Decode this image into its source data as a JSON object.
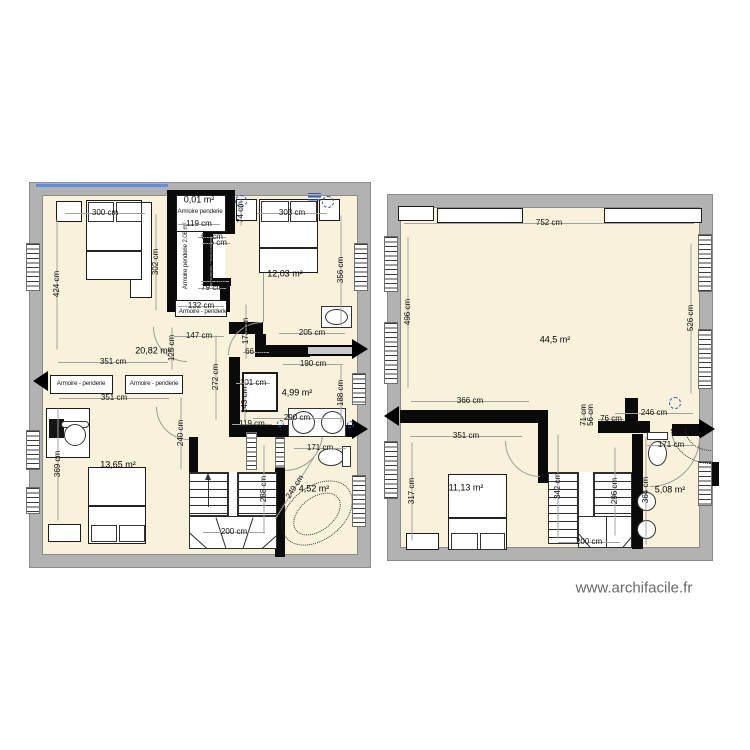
{
  "watermark": "www.archifacile.fr",
  "colors": {
    "floor": "#f8f2da",
    "outer_wall": "#b2b2b2",
    "inner_wall": "#0a0a0a",
    "dimension_line": "#a3a3a3",
    "accent_blue": "#2e58c8",
    "top_wall_highlight": "#5b8def",
    "watermark_text": "#686868"
  },
  "plans": [
    {
      "id": "left",
      "labels": [
        {
          "t": "0,01 m²",
          "x": 199,
          "y": 200,
          "k": "area"
        },
        {
          "t": "12,03 m²",
          "x": 285,
          "y": 274,
          "k": "area"
        },
        {
          "t": "20,82 m²",
          "x": 153,
          "y": 351,
          "k": "area"
        },
        {
          "t": "4,99 m²",
          "x": 297,
          "y": 393,
          "k": "area"
        },
        {
          "t": "13,65 m²",
          "x": 118,
          "y": 465,
          "k": "area"
        },
        {
          "t": "4,52 m²",
          "x": 314,
          "y": 489,
          "k": "area"
        },
        {
          "t": "Armoire penderie",
          "x": 200,
          "y": 212,
          "k": "furn"
        },
        {
          "t": "Armoire penderie 2,08 m²",
          "x": 186,
          "y": 256,
          "k": "furn",
          "rot": -90
        },
        {
          "t": "Armoire - penderie",
          "x": 203,
          "y": 312,
          "k": "furn"
        },
        {
          "t": "Armoire - penderie",
          "x": 81,
          "y": 384,
          "k": "furn"
        },
        {
          "t": "Armoire - penderie",
          "x": 154,
          "y": 384,
          "k": "furn"
        },
        {
          "t": "300 cm",
          "x": 105,
          "y": 213,
          "len": 80
        },
        {
          "t": "303 cm",
          "x": 292,
          "y": 213,
          "len": 70
        },
        {
          "t": "119 cm",
          "x": 199,
          "y": 224,
          "len": 42
        },
        {
          "t": "74 cm",
          "x": 241,
          "y": 212,
          "len": 26,
          "rot": -90
        },
        {
          "t": "66 cm",
          "x": 212,
          "y": 237,
          "len": 28
        },
        {
          "t": "66 cm",
          "x": 216,
          "y": 243,
          "len": 28
        },
        {
          "t": "154 cm",
          "x": 211,
          "y": 261,
          "len": 50,
          "rot": -90
        },
        {
          "t": "302 cm",
          "x": 156,
          "y": 262,
          "len": 96,
          "rot": -90
        },
        {
          "t": "356 cm",
          "x": 341,
          "y": 270,
          "len": 110,
          "rot": -90
        },
        {
          "t": "424 cm",
          "x": 57,
          "y": 284,
          "len": 130,
          "rot": -90
        },
        {
          "t": "79 cm",
          "x": 215,
          "y": 281,
          "len": 28
        },
        {
          "t": "79 cm",
          "x": 212,
          "y": 288,
          "len": 28
        },
        {
          "t": "132 cm",
          "x": 201,
          "y": 306,
          "len": 46
        },
        {
          "t": "147 cm",
          "x": 199,
          "y": 336,
          "len": 50
        },
        {
          "t": "173 cm",
          "x": 246,
          "y": 331,
          "len": 54,
          "rot": -90
        },
        {
          "t": "125 cm",
          "x": 172,
          "y": 348,
          "len": 42,
          "rot": -90
        },
        {
          "t": "205 cm",
          "x": 312,
          "y": 333,
          "len": 66
        },
        {
          "t": "351 cm",
          "x": 113,
          "y": 362,
          "len": 110
        },
        {
          "t": "190 cm",
          "x": 313,
          "y": 364,
          "len": 60
        },
        {
          "t": "66 cm",
          "x": 256,
          "y": 352,
          "len": 26
        },
        {
          "t": "272 cm",
          "x": 216,
          "y": 377,
          "len": 84,
          "rot": -90
        },
        {
          "t": "101 cm",
          "x": 253,
          "y": 383,
          "len": 34
        },
        {
          "t": "143 cm",
          "x": 245,
          "y": 400,
          "len": 42,
          "rot": -90
        },
        {
          "t": "188 cm",
          "x": 341,
          "y": 393,
          "len": 58,
          "rot": -90
        },
        {
          "t": "290 cm",
          "x": 297,
          "y": 418,
          "len": 88
        },
        {
          "t": "119 cm",
          "x": 252,
          "y": 424,
          "len": 40
        },
        {
          "t": "171 cm",
          "x": 320,
          "y": 448,
          "len": 52
        },
        {
          "t": "351 cm",
          "x": 114,
          "y": 398,
          "len": 110
        },
        {
          "t": "240 cm",
          "x": 181,
          "y": 433,
          "len": 72,
          "rot": -90
        },
        {
          "t": "369 cm",
          "x": 58,
          "y": 464,
          "len": 112,
          "rot": -90
        },
        {
          "t": "288 cm",
          "x": 264,
          "y": 489,
          "len": 88,
          "rot": -90
        },
        {
          "t": "249 cm",
          "x": 295,
          "y": 487,
          "len": 74,
          "rot": -58
        },
        {
          "t": "200 cm",
          "x": 234,
          "y": 532,
          "len": 62
        }
      ]
    },
    {
      "id": "right",
      "labels": [
        {
          "t": "44,5 m²",
          "x": 555,
          "y": 340,
          "k": "area"
        },
        {
          "t": "11,13 m²",
          "x": 466,
          "y": 488,
          "k": "area"
        },
        {
          "t": "5,08 m²",
          "x": 670,
          "y": 490,
          "k": "area"
        },
        {
          "t": "752 cm",
          "x": 549,
          "y": 223,
          "len": 290
        },
        {
          "t": "496 cm",
          "x": 408,
          "y": 312,
          "len": 150,
          "rot": -90
        },
        {
          "t": "526 cm",
          "x": 691,
          "y": 318,
          "len": 150,
          "rot": -90
        },
        {
          "t": "366 cm",
          "x": 470,
          "y": 401,
          "len": 118
        },
        {
          "t": "351 cm",
          "x": 466,
          "y": 436,
          "len": 112
        },
        {
          "t": "317 cm",
          "x": 412,
          "y": 491,
          "len": 98,
          "rot": -90
        },
        {
          "t": "71 cm",
          "x": 584,
          "y": 415,
          "len": 22,
          "rot": -90
        },
        {
          "t": "56 cm",
          "x": 591,
          "y": 415,
          "len": 18,
          "rot": -90
        },
        {
          "t": "76 cm",
          "x": 611,
          "y": 419,
          "len": 26
        },
        {
          "t": "246 cm",
          "x": 654,
          "y": 413,
          "len": 78
        },
        {
          "t": "171 cm",
          "x": 671,
          "y": 445,
          "len": 48
        },
        {
          "t": "342 cm",
          "x": 558,
          "y": 486,
          "len": 104,
          "rot": -90
        },
        {
          "t": "296 cm",
          "x": 615,
          "y": 491,
          "len": 88,
          "rot": -90
        },
        {
          "t": "364 cm",
          "x": 646,
          "y": 490,
          "len": 108,
          "rot": -90
        },
        {
          "t": "200 cm",
          "x": 589,
          "y": 542,
          "len": 62
        }
      ]
    }
  ]
}
